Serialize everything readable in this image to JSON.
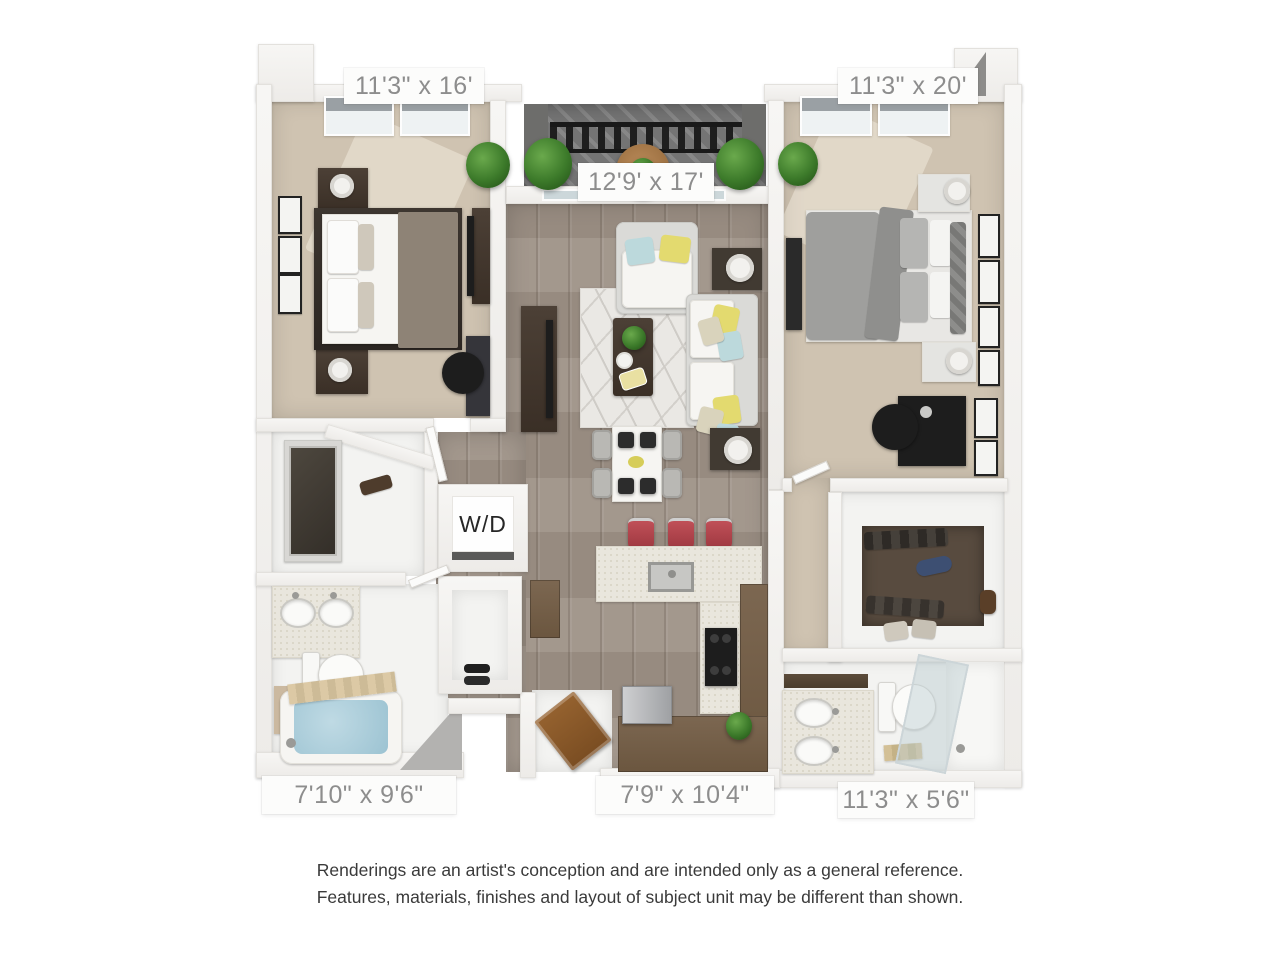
{
  "floorplan": {
    "type": "apartment-floor-plan-3d-render",
    "labels": {
      "bedroom_left": "11'3\" x 16'",
      "balcony": "12'9' x 17'",
      "bedroom_right": "11'3\" x 20'",
      "bathroom_left": "7'10\" x 9'6\"",
      "kitchen": "7'9\" x 10'4\"",
      "bathroom_right": "11'3\" x 5'6\"",
      "washer_dryer": "W/D"
    },
    "colors": {
      "wall": "#f4f3f1",
      "carpet": "#cfc3b1",
      "wood_floor": "#9e9287",
      "balcony_deck": "#767676",
      "counter_speckled": "#e9e6dd",
      "cabinet_brown": "#73604a",
      "stool_red": "#b0444a",
      "tub_water": "#a9ccd9",
      "accent_pillow_yellow": "#e3da6f",
      "accent_pillow_teal": "#bcd9dc",
      "label_text": "#8d8d8d",
      "disclaimer_text": "#3a3a3a"
    }
  },
  "disclaimer": {
    "line1": "Renderings are an artist's conception and are intended only as a general reference.",
    "line2": "Features, materials, finishes and layout of subject unit may be different than shown."
  }
}
